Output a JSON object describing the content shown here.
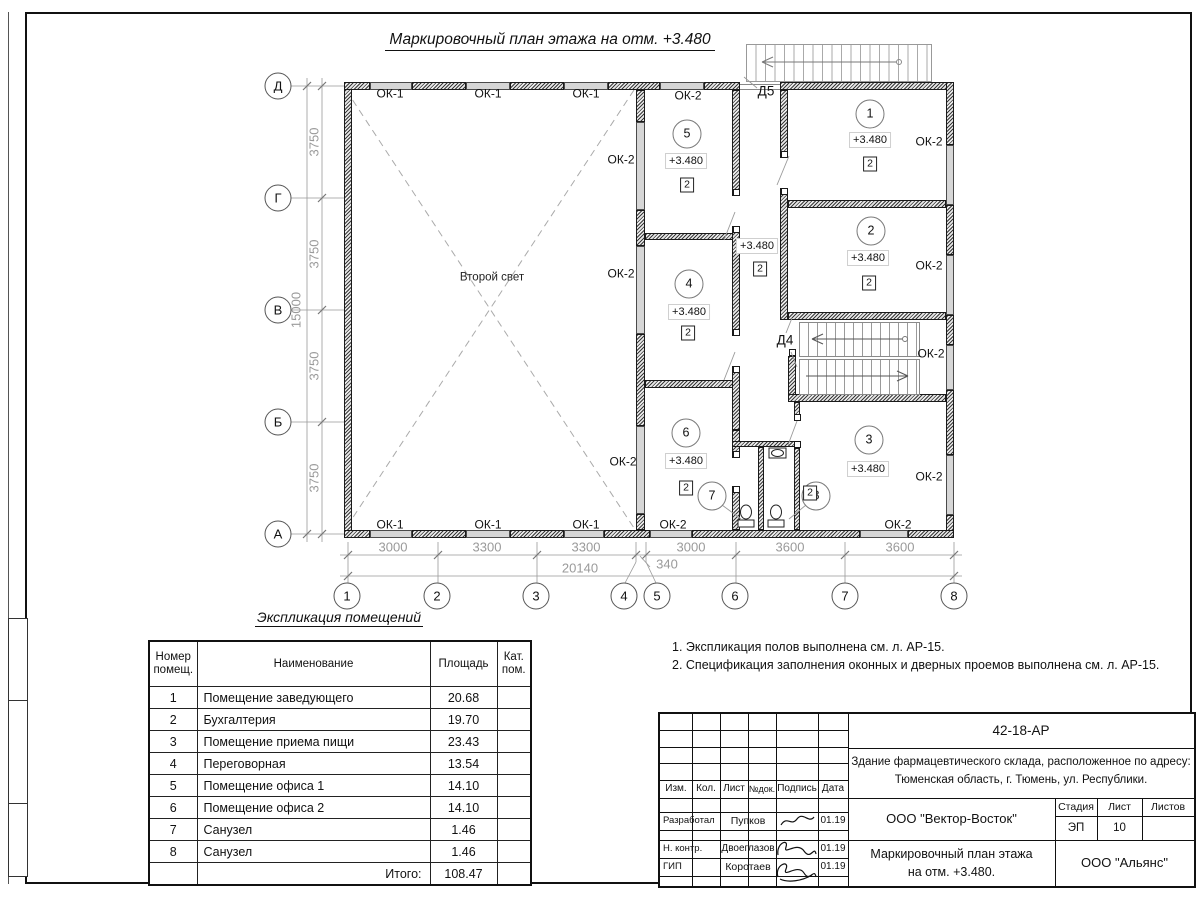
{
  "sheet": {
    "plan_title": "Маркировочный план этажа на отм. +3.480",
    "second_light": "Второй свет"
  },
  "plan": {
    "ok_labels": [
      {
        "t": "ОК-1",
        "x": 390,
        "y": 94
      },
      {
        "t": "ОК-1",
        "x": 488,
        "y": 94
      },
      {
        "t": "ОК-1",
        "x": 586,
        "y": 94
      },
      {
        "t": "ОК-2",
        "x": 688,
        "y": 96
      },
      {
        "t": "ОК-2",
        "x": 621,
        "y": 160
      },
      {
        "t": "ОК-2",
        "x": 621,
        "y": 274
      },
      {
        "t": "ОК-2",
        "x": 623,
        "y": 462
      },
      {
        "t": "ОК-2",
        "x": 929,
        "y": 142
      },
      {
        "t": "ОК-2",
        "x": 929,
        "y": 266
      },
      {
        "t": "ОК-2",
        "x": 931,
        "y": 354
      },
      {
        "t": "ОК-2",
        "x": 929,
        "y": 477
      },
      {
        "t": "ОК-1",
        "x": 390,
        "y": 525
      },
      {
        "t": "ОК-1",
        "x": 488,
        "y": 525
      },
      {
        "t": "ОК-1",
        "x": 586,
        "y": 525
      },
      {
        "t": "ОК-2",
        "x": 673,
        "y": 525
      },
      {
        "t": "ОК-2",
        "x": 898,
        "y": 525
      }
    ],
    "room_circles": [
      {
        "t": "1",
        "x": 870,
        "y": 114
      },
      {
        "t": "2",
        "x": 871,
        "y": 231
      },
      {
        "t": "3",
        "x": 869,
        "y": 440
      },
      {
        "t": "4",
        "x": 689,
        "y": 284
      },
      {
        "t": "5",
        "x": 687,
        "y": 134
      },
      {
        "t": "6",
        "x": 686,
        "y": 433
      },
      {
        "t": "7",
        "x": 712,
        "y": 496
      },
      {
        "t": "8",
        "x": 816,
        "y": 496
      }
    ],
    "elevations": [
      {
        "t": "+3.480",
        "x": 870,
        "y": 140
      },
      {
        "t": "+3.480",
        "x": 868,
        "y": 258
      },
      {
        "t": "+3.480",
        "x": 868,
        "y": 469
      },
      {
        "t": "+3.480",
        "x": 689,
        "y": 312
      },
      {
        "t": "+3.480",
        "x": 686,
        "y": 161
      },
      {
        "t": "+3.480",
        "x": 686,
        "y": 461
      },
      {
        "t": "+3.480",
        "x": 757,
        "y": 246
      }
    ],
    "cat_markers": [
      {
        "t": "2",
        "x": 870,
        "y": 164
      },
      {
        "t": "2",
        "x": 869,
        "y": 283
      },
      {
        "t": "2",
        "x": 810,
        "y": 493
      },
      {
        "t": "2",
        "x": 688,
        "y": 333
      },
      {
        "t": "2",
        "x": 687,
        "y": 185
      },
      {
        "t": "2",
        "x": 686,
        "y": 488
      },
      {
        "t": "2",
        "x": 760,
        "y": 269
      }
    ],
    "door_labels": [
      {
        "t": "Д5",
        "x": 766,
        "y": 91
      },
      {
        "t": "Д4",
        "x": 785,
        "y": 340
      }
    ],
    "axes_left": [
      {
        "t": "Д",
        "x": 278,
        "y": 86
      },
      {
        "t": "Г",
        "x": 278,
        "y": 198
      },
      {
        "t": "В",
        "x": 278,
        "y": 310
      },
      {
        "t": "Б",
        "x": 278,
        "y": 422
      },
      {
        "t": "А",
        "x": 278,
        "y": 534
      }
    ],
    "axes_bottom": [
      {
        "t": "1",
        "x": 347,
        "y": 596
      },
      {
        "t": "2",
        "x": 437,
        "y": 596
      },
      {
        "t": "3",
        "x": 536,
        "y": 596
      },
      {
        "t": "4",
        "x": 624,
        "y": 596
      },
      {
        "t": "5",
        "x": 657,
        "y": 596
      },
      {
        "t": "6",
        "x": 735,
        "y": 596
      },
      {
        "t": "7",
        "x": 845,
        "y": 596
      },
      {
        "t": "8",
        "x": 954,
        "y": 596
      }
    ],
    "dims_bottom": [
      {
        "t": "3000",
        "x": 393,
        "y": 547
      },
      {
        "t": "3300",
        "x": 487,
        "y": 547
      },
      {
        "t": "3300",
        "x": 586,
        "y": 547
      },
      {
        "t": "3000",
        "x": 691,
        "y": 547
      },
      {
        "t": "3600",
        "x": 790,
        "y": 547
      },
      {
        "t": "3600",
        "x": 900,
        "y": 547
      },
      {
        "t": "340",
        "x": 667,
        "y": 564
      },
      {
        "t": "20140",
        "x": 580,
        "y": 568
      }
    ],
    "dims_left": [
      {
        "t": "3750",
        "x": 314,
        "y": 142
      },
      {
        "t": "3750",
        "x": 314,
        "y": 254
      },
      {
        "t": "3750",
        "x": 314,
        "y": 366
      },
      {
        "t": "3750",
        "x": 314,
        "y": 478
      },
      {
        "t": "15000",
        "x": 296,
        "y": 310
      }
    ]
  },
  "table": {
    "title": "Экспликация помещений",
    "headers": {
      "num": "Номер помещ.",
      "name": "Наименование",
      "area": "Площадь",
      "cat": "Кат. пом."
    },
    "rows": [
      {
        "num": "1",
        "name": "Помещение заведующего",
        "area": "20.68",
        "cat": ""
      },
      {
        "num": "2",
        "name": "Бухгалтерия",
        "area": "19.70",
        "cat": ""
      },
      {
        "num": "3",
        "name": "Помещение приема пищи",
        "area": "23.43",
        "cat": ""
      },
      {
        "num": "4",
        "name": "Переговорная",
        "area": "13.54",
        "cat": ""
      },
      {
        "num": "5",
        "name": "Помещение офиса 1",
        "area": "14.10",
        "cat": ""
      },
      {
        "num": "6",
        "name": "Помещение офиса 2",
        "area": "14.10",
        "cat": ""
      },
      {
        "num": "7",
        "name": "Санузел",
        "area": "1.46",
        "cat": ""
      },
      {
        "num": "8",
        "name": "Санузел",
        "area": "1.46",
        "cat": ""
      }
    ],
    "total_label": "Итого:",
    "total": "108.47"
  },
  "notes": {
    "items": [
      "1. Экспликация полов выполнена см. л. АР-15.",
      "2. Спецификация заполнения оконных и дверных проемов выполнена см. л. АР-15."
    ]
  },
  "titleblock": {
    "doc_number": "42-18-АР",
    "address_line1": "Здание фармацевтического склада, расположенное по адресу:",
    "address_line2": "Тюменская область, г. Тюмень, ул. Республики.",
    "col_izm": "Изм.",
    "col_kol": "Кол.",
    "col_list": "Лист",
    "col_ndok": "№док.",
    "col_podpis": "Подпись",
    "col_data": "Дата",
    "row1_role": "Разработал",
    "row1_name": "Пупков",
    "row1_date": "01.19",
    "row2_role": "Н. контр.",
    "row2_name": "Двоеглазов",
    "row2_date": "01.19",
    "row3_role": "ГИП",
    "row3_name": "Коротаев",
    "row3_date": "01.19",
    "company": "ООО \"Вектор-Восток\"",
    "stage_label": "Стадия",
    "sheet_label": "Лист",
    "sheets_label": "Листов",
    "stage": "ЭП",
    "sheet": "10",
    "sheets": "",
    "drawing_title_line1": "Маркировочный план этажа",
    "drawing_title_line2": "на отм. +3.480.",
    "org": "ООО \"Альянс\""
  }
}
